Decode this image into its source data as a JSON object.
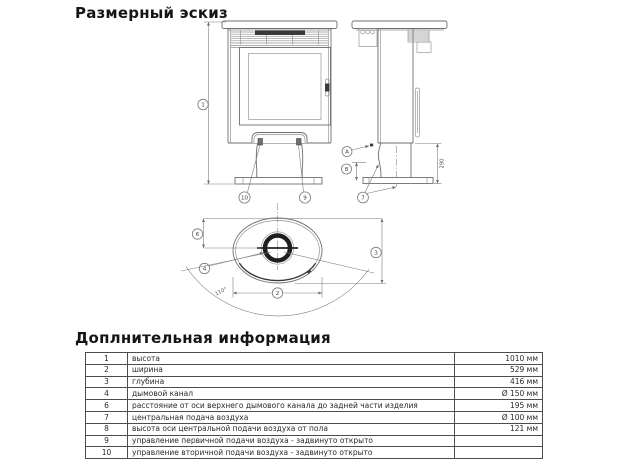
{
  "titles": {
    "drawing": "Размерный эскиз",
    "info": "Доплнительная информация"
  },
  "drawing": {
    "callouts": {
      "height": "1",
      "width": "2",
      "depth": "3",
      "flue": "4",
      "flue_axis_to_back": "6",
      "central_air": "7",
      "air_axis_height": "8",
      "primary_air_control": "9",
      "secondary_air_control": "10",
      "detail_a": "A"
    },
    "dimensions": {
      "pedestal_height": "290",
      "door_opening_angle": "110°"
    }
  },
  "table": {
    "rows": [
      {
        "num": "1",
        "name": "высота",
        "value": "1010 мм"
      },
      {
        "num": "2",
        "name": "ширина",
        "value": "529 мм"
      },
      {
        "num": "3",
        "name": "глубина",
        "value": "416 мм"
      },
      {
        "num": "4",
        "name": "дымовой канал",
        "value": "Ø 150 мм"
      },
      {
        "num": "6",
        "name": "расстояние от оси верхнего дымового канала до задней части изделия",
        "value": "195 мм"
      },
      {
        "num": "7",
        "name": "центральная подача воздуха",
        "value": "Ø 100 мм"
      },
      {
        "num": "8",
        "name": "высота оси центральной подачи воздуха от пола",
        "value": "121 мм"
      },
      {
        "num": "9",
        "name": "управление первичной подачи воздуха - задвинуто открыто",
        "value": ""
      },
      {
        "num": "10",
        "name": "управление вторичной подачи воздуха - задвинуто открыто",
        "value": ""
      }
    ]
  }
}
